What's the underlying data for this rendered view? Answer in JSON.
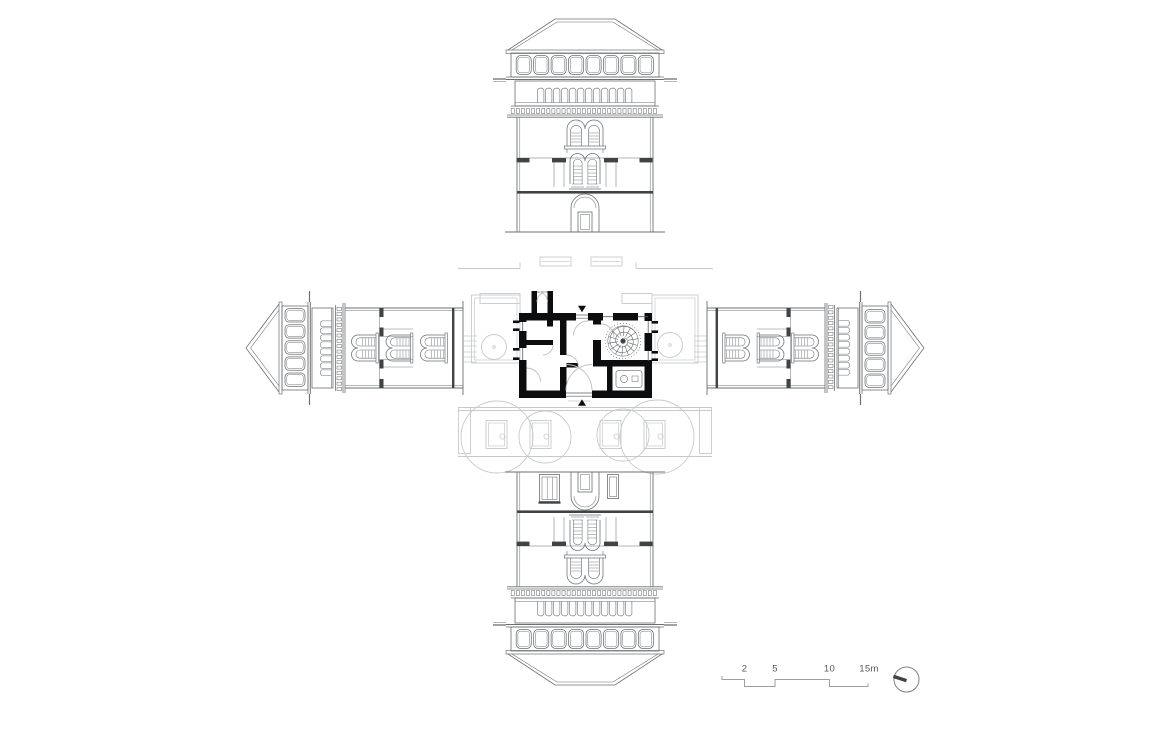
{
  "scale_bar": {
    "labels": [
      "2",
      "5",
      "10",
      "15m"
    ]
  },
  "north_arrow": {
    "icon": "north-compass-icon"
  },
  "colors": {
    "background": "#ffffff",
    "elevation_line": "#6a6f72",
    "detail_dark": "#3e4347",
    "context_line": "#c7cacc",
    "wall_fill": "#0c0d0e",
    "plan_line": "#5a5e61",
    "door_arc": "#bdc1c3",
    "fixture_line": "#7e8284",
    "scale_text": "#55595c",
    "scale_line": "#9aa0a2"
  }
}
